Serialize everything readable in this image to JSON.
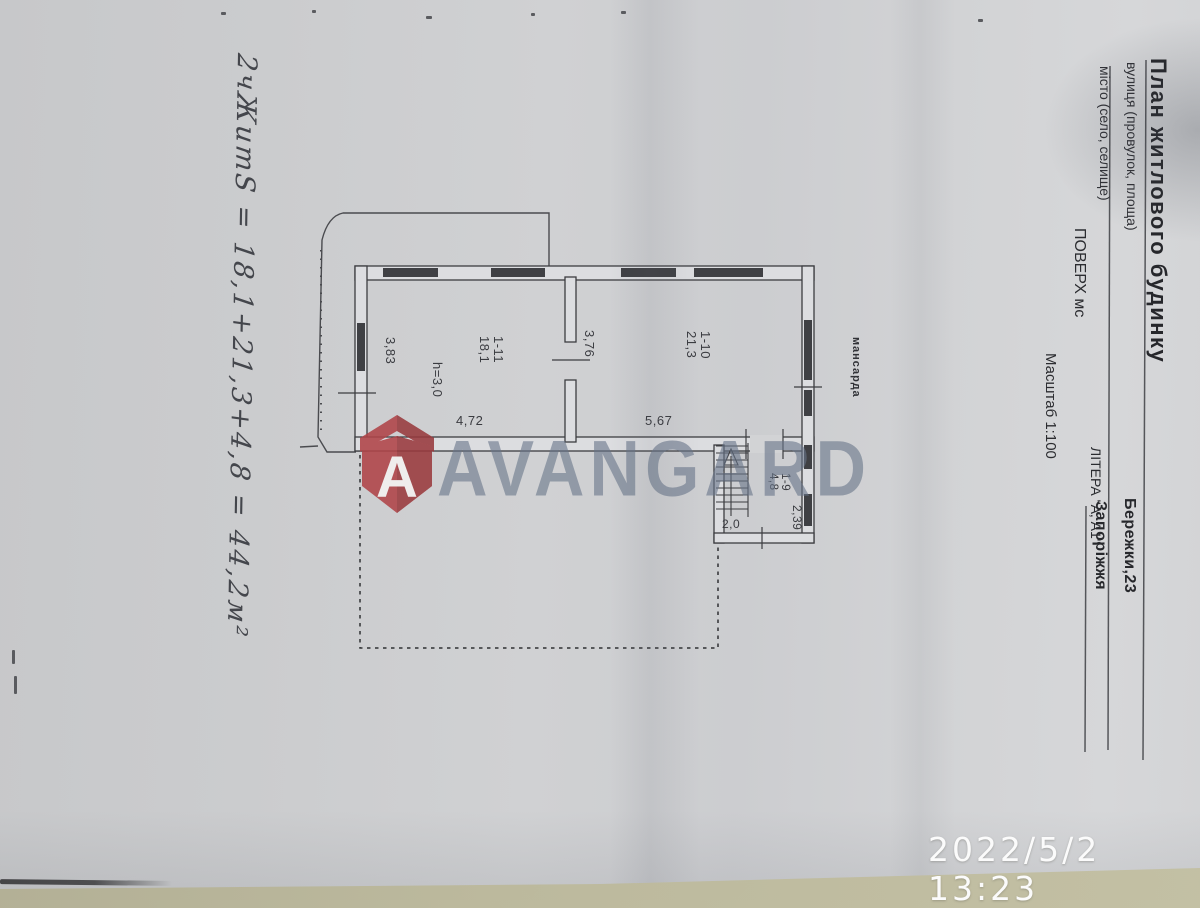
{
  "form": {
    "title": "План житлового будинку",
    "street_label": "вулиця (провулок, площа)",
    "street_value": "Бережки,23",
    "city_label": "місто (село, селище)",
    "city_value": "Запоріжжя",
    "floor_label": "ПОВЕРХ  мс",
    "litera_label": "ЛІТЕРА  \"А, А1\"",
    "scale_label": "Масштаб 1:100"
  },
  "plan": {
    "mansard_label": "мансарда",
    "rooms": [
      {
        "id": "1-11",
        "area": "18,1"
      },
      {
        "id": "1-10",
        "area": "21,3"
      },
      {
        "id": "1-9",
        "area": "4,8"
      }
    ],
    "height_note": "h=3,0",
    "dimensions": {
      "room1_left": "3,83",
      "room1_bottom": "4,72",
      "wall_between": "3,76",
      "room2_bottom": "5,67",
      "stair_right": "2,39",
      "stair_bottom": "2,0"
    }
  },
  "handwriting": {
    "note": "2чЖитS = 18,1+21,3+4,8 = 44,2м²"
  },
  "watermark": {
    "brand": "AVANGARD",
    "logo_letter": "A",
    "text_color": "#677589",
    "logo_color": "#b04448"
  },
  "camera": {
    "timestamp": "2022/5/2 13:23"
  }
}
